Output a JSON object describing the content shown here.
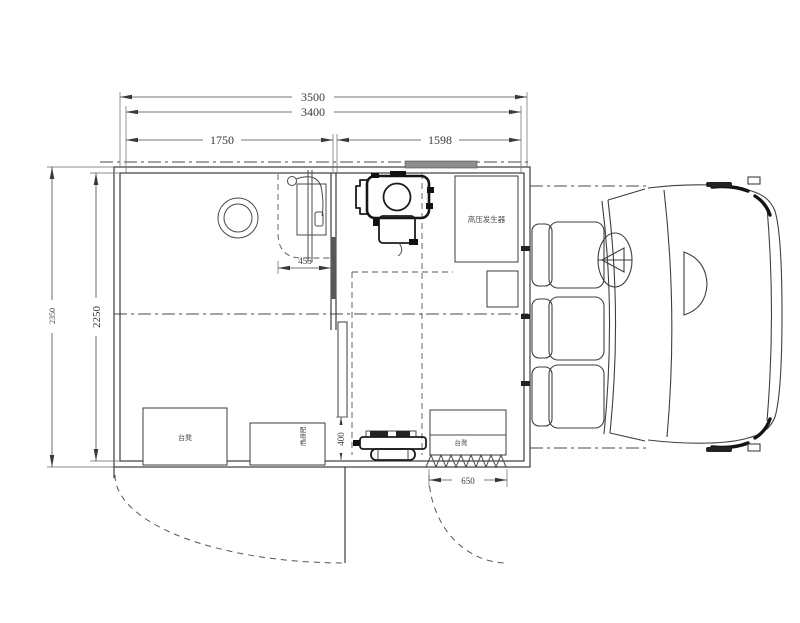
{
  "dimensions": {
    "overall_length": "3500",
    "inner_length": "3400",
    "left_section": "1750",
    "right_section": "1598",
    "overall_width": "2350",
    "inner_width": "2250",
    "stand_offset": "455",
    "rear_gap": "400",
    "step_width": "650"
  },
  "labels": {
    "hv_generator": "高压发生器",
    "bench_left": "台凳",
    "power_cabinet": "配电柜",
    "bench_right": "台凳"
  }
}
